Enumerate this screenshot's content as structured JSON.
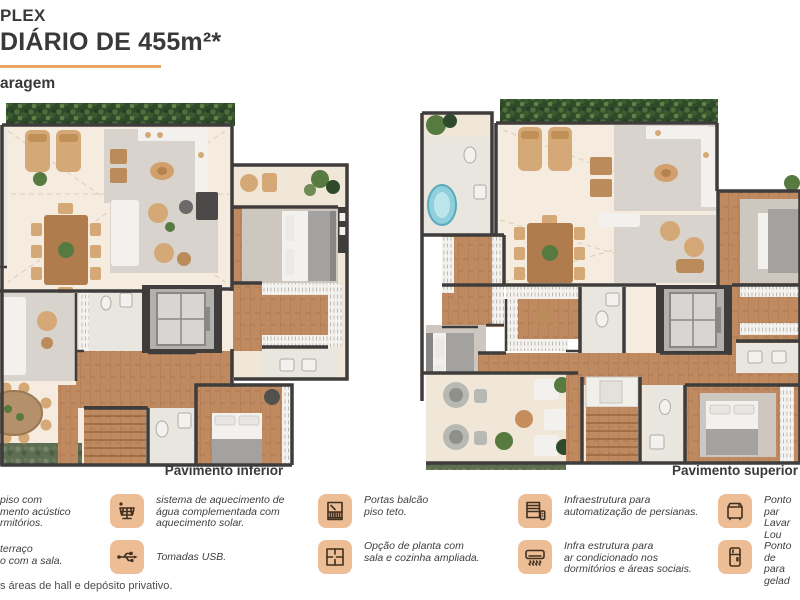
{
  "header": {
    "title_line1": "PLEX",
    "title_line2": "DIÁRIO DE 455m²*",
    "subtitle": "aragem"
  },
  "plans": {
    "left_label": "Pavimento inferior",
    "right_label": "Pavimento superior"
  },
  "legend": {
    "items": [
      {
        "id": "acoustic-floor",
        "l1": "piso com",
        "l2": "mento acústico",
        "l3": "rmitórios."
      },
      {
        "id": "terrace-integration",
        "l1": "terraço",
        "l2": "o com a sala.",
        "l3": ""
      },
      {
        "id": "solar-water-heating",
        "icon": "solar-panel-icon",
        "l1": "sistema de aquecimento de",
        "l2": "água complementada com",
        "l3": "aquecimento solar."
      },
      {
        "id": "usb-outlets",
        "icon": "usb-icon",
        "l1": "Tomadas USB.",
        "l2": "",
        "l3": ""
      },
      {
        "id": "floor-to-ceiling-doors",
        "icon": "balcony-door-icon",
        "l1": "Portas balcão",
        "l2": "piso teto.",
        "l3": ""
      },
      {
        "id": "extended-layout-option",
        "icon": "floor-plan-icon",
        "l1": "Opção de planta com",
        "l2": "sala e cozinha ampliada.",
        "l3": ""
      },
      {
        "id": "blind-automation",
        "icon": "blinds-icon",
        "l1": "Infraestrutura para",
        "l2": "automatização de persianas.",
        "l3": ""
      },
      {
        "id": "air-conditioning",
        "icon": "air-conditioner-icon",
        "l1": "Infra estrutura para",
        "l2": "ar condicionado nos",
        "l3": "dormitórios e áreas sociais."
      },
      {
        "id": "dishwasher-point",
        "icon": "dishwasher-icon",
        "l1": "Ponto par",
        "l2": "Lavar Lou",
        "l3": ""
      },
      {
        "id": "fridge-point",
        "icon": "refrigerator-icon",
        "l1": "Ponto de",
        "l2": "para gelad",
        "l3": ""
      }
    ],
    "footnote": "s áreas de hall e depósito privativo."
  },
  "colors": {
    "accent": "#E7A565",
    "icon_bg": "#EDBD96",
    "wall": "#3E3D3C",
    "wood": "#C08A61",
    "cream": "#F5EBDE",
    "rug": "#D8D3CC"
  }
}
